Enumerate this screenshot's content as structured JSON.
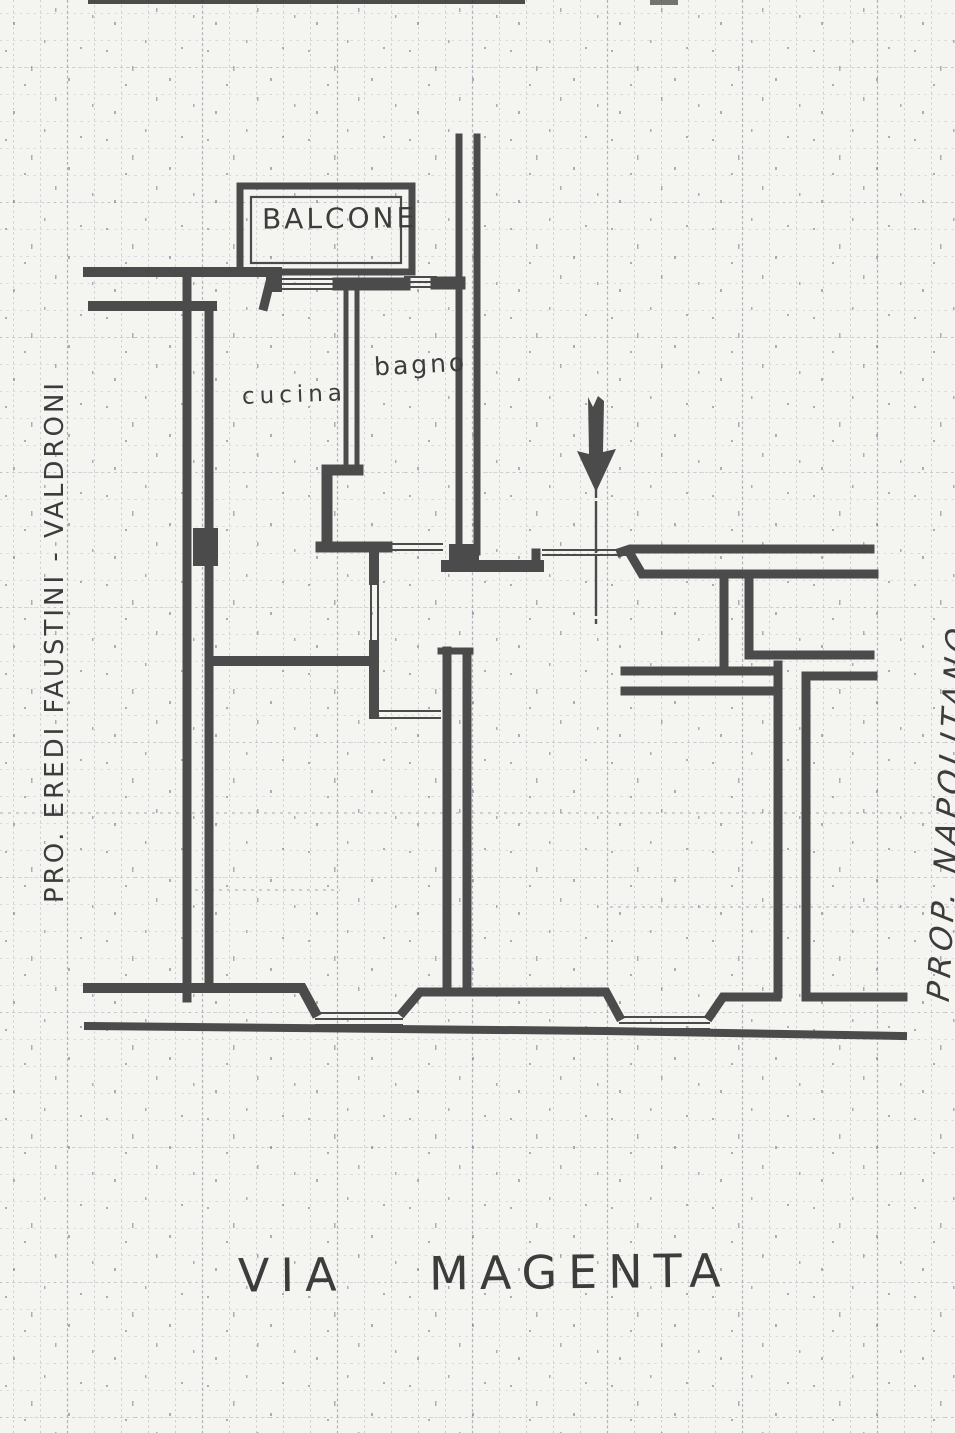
{
  "page": {
    "kind": "scanned hand-drawn floor plan on graph paper",
    "street_label": "VIA MAGENTA",
    "room_labels": {
      "balcony": "BALCONE",
      "bathroom": "bagno",
      "kitchen": "cucina"
    },
    "adjacent_property_labels": {
      "left": "PRO. EREDI FAUSTINI - VALDRONI",
      "right": "PROP. NAPOLITANO"
    },
    "entrance_marker": "down-arrow",
    "colors": {
      "paper": "#f4f4f1",
      "ink": "#3c3c3c",
      "wall": "#4b4b4b",
      "grid": "#8d96a5"
    }
  }
}
